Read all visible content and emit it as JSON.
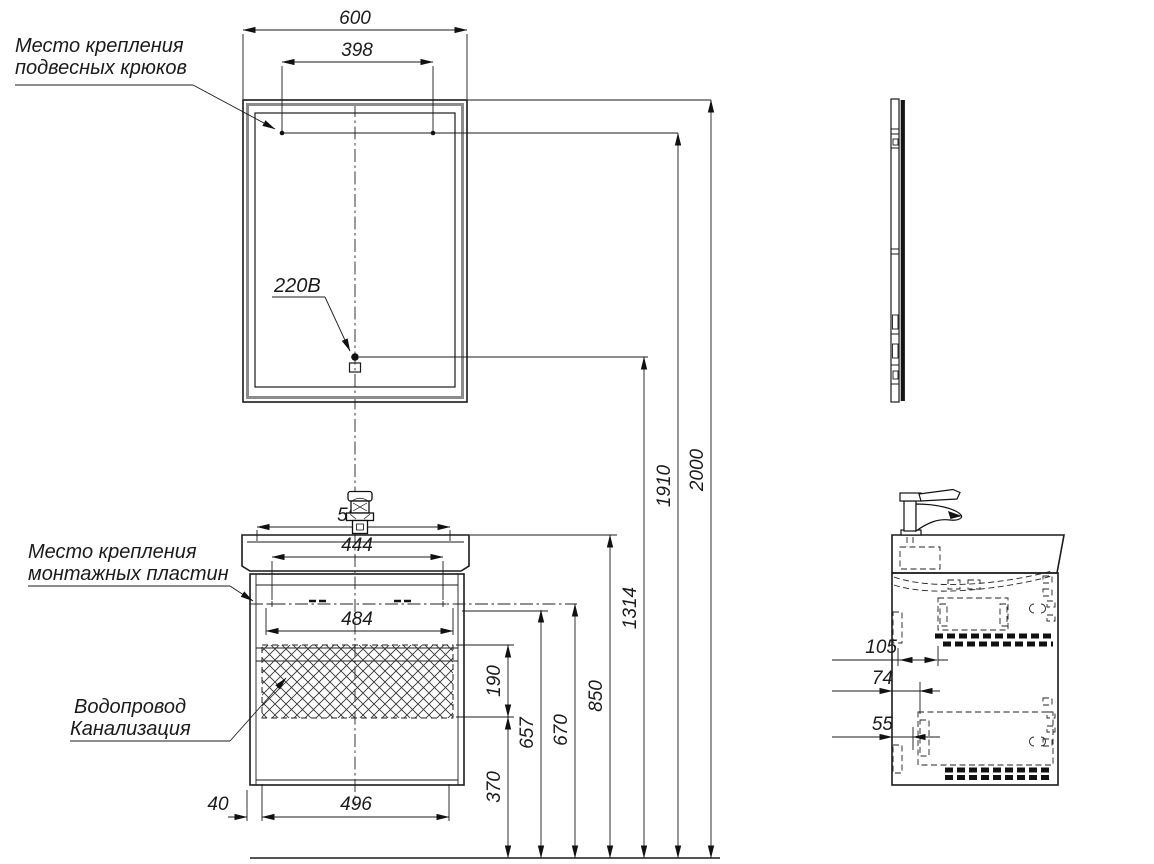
{
  "labels": {
    "hooks_line1": "Место крепления",
    "hooks_line2": "подвесных крюков",
    "outlet": "220В",
    "plates_line1": "Место крепления",
    "plates_line2": "монтажных пластин",
    "plumbing_line1": "Водопровод",
    "plumbing_line2": "Канализация"
  },
  "dimensions": {
    "front": {
      "mirror_width": "600",
      "hook_spacing": "398",
      "basin_top_width": "504",
      "plate_spacing_inner": "444",
      "plate_spacing_outer": "484",
      "drawer_width": "496",
      "left_offset": "40",
      "plumbing_zone_height": "190",
      "plumbing_zone_bottom": "370",
      "plate_height_bottom": "657",
      "plate_height_top": "670",
      "cabinet_top_height": "850",
      "outlet_height": "1314",
      "hook_height": "1910",
      "mirror_top_height": "2000"
    },
    "side": {
      "depth_offset_1": "105",
      "depth_offset_2": "74",
      "depth_offset_3": "55"
    }
  },
  "colors": {
    "line": "#1b1b1b",
    "mirror_frame": "#8c8c8c",
    "background": "#ffffff"
  }
}
